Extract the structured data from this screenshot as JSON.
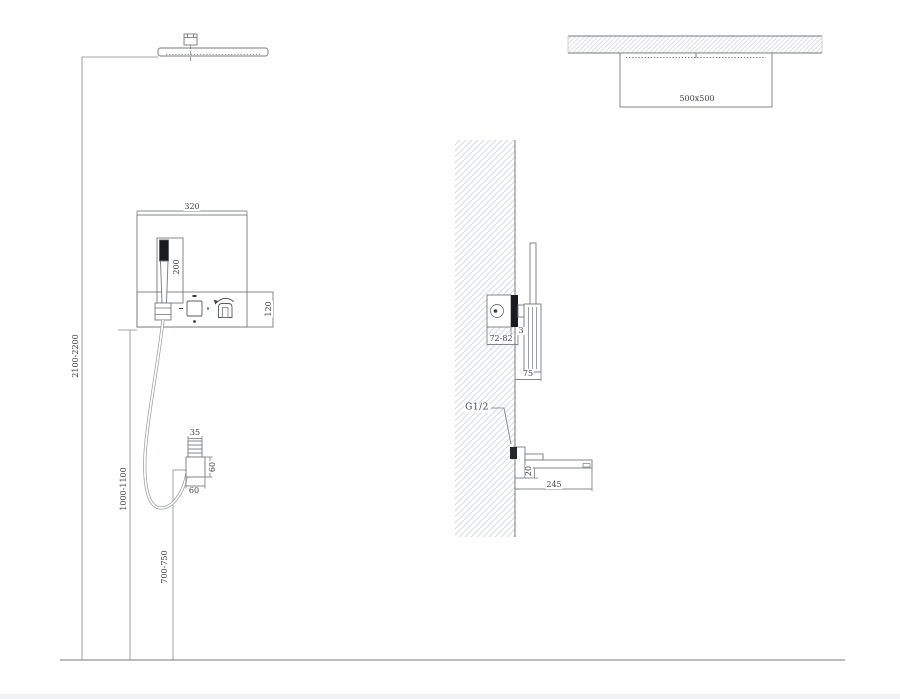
{
  "views": {
    "front": {
      "dim_head_to_floor": "2100-2200",
      "dim_panel_width": "320",
      "dim_handshower_length": "200",
      "dim_panel_row_height": "120",
      "dim_panel_to_floor": "1000-1100",
      "dim_outlet_to_floor": "700-750",
      "dim_outlet_neck_width": "35",
      "dim_outlet_height": "60",
      "dim_outlet_width": "60"
    },
    "plan": {
      "dim_head_size": "500x500"
    },
    "section": {
      "dim_valve_recess_depth": "72-82",
      "dim_trim_plate_thickness": "3",
      "dim_holder_projection": "75",
      "thread_label": "G1/2",
      "dim_spout_body_height": "20",
      "dim_spout_reach": "245"
    }
  },
  "colors": {
    "line": "#74787e",
    "dim_line": "#84888e",
    "dark_fill": "#1a1b1e",
    "text": "#3f4247",
    "hatch": "#d6d9de"
  }
}
